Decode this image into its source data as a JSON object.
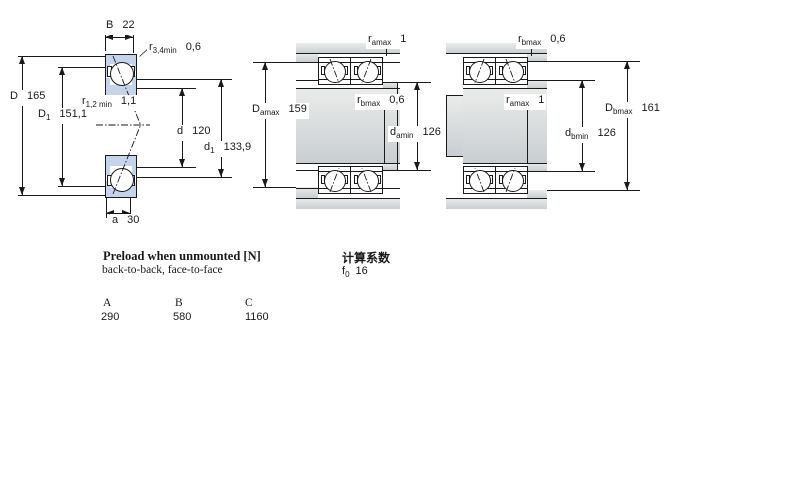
{
  "colors": {
    "ring_fill": "#c6d4eb",
    "metal_light": "#e9ece9",
    "metal_dark": "#c9ced2"
  },
  "figures": {
    "cross_section": {
      "dim_B": {
        "sym": "B",
        "sub": "",
        "val": "22"
      },
      "dim_r34": {
        "sym": "r",
        "sub": "3,4min",
        "val": "0,6"
      },
      "dim_D": {
        "sym": "D",
        "sub": "",
        "val": "165"
      },
      "dim_r12": {
        "sym": "r",
        "sub": "1,2 min",
        "val": "1,1"
      },
      "dim_D1": {
        "sym": "D",
        "sub": "1",
        "val": "151,1"
      },
      "dim_d": {
        "sym": "d",
        "sub": "",
        "val": "120"
      },
      "dim_d1": {
        "sym": "d",
        "sub": "1",
        "val": "133,9"
      },
      "dim_a": {
        "sym": "a",
        "sub": "",
        "val": "30"
      }
    },
    "mounting_left": {
      "dim_ra": {
        "sym": "r",
        "sub": "amax",
        "val": "1"
      },
      "dim_rb": {
        "sym": "r",
        "sub": "bmax",
        "val": "0,6"
      },
      "dim_Da": {
        "sym": "D",
        "sub": "amax",
        "val": "159"
      },
      "dim_da": {
        "sym": "d",
        "sub": "amin",
        "val": "126"
      }
    },
    "mounting_right": {
      "dim_rb": {
        "sym": "r",
        "sub": "bmax",
        "val": "0,6"
      },
      "dim_ra": {
        "sym": "r",
        "sub": "amax",
        "val": "1"
      },
      "dim_Db": {
        "sym": "D",
        "sub": "bmax",
        "val": "161"
      },
      "dim_db": {
        "sym": "d",
        "sub": "bmin",
        "val": "126"
      }
    }
  },
  "preload": {
    "title": "Preload when unmounted [N]",
    "subtitle": "back-to-back, face-to-face",
    "columns": [
      "A",
      "B",
      "C"
    ],
    "values": [
      "290",
      "580",
      "1160"
    ]
  },
  "calc": {
    "heading": "计算系数",
    "f0": {
      "sym": "f",
      "sub": "0",
      "val": "16"
    }
  }
}
